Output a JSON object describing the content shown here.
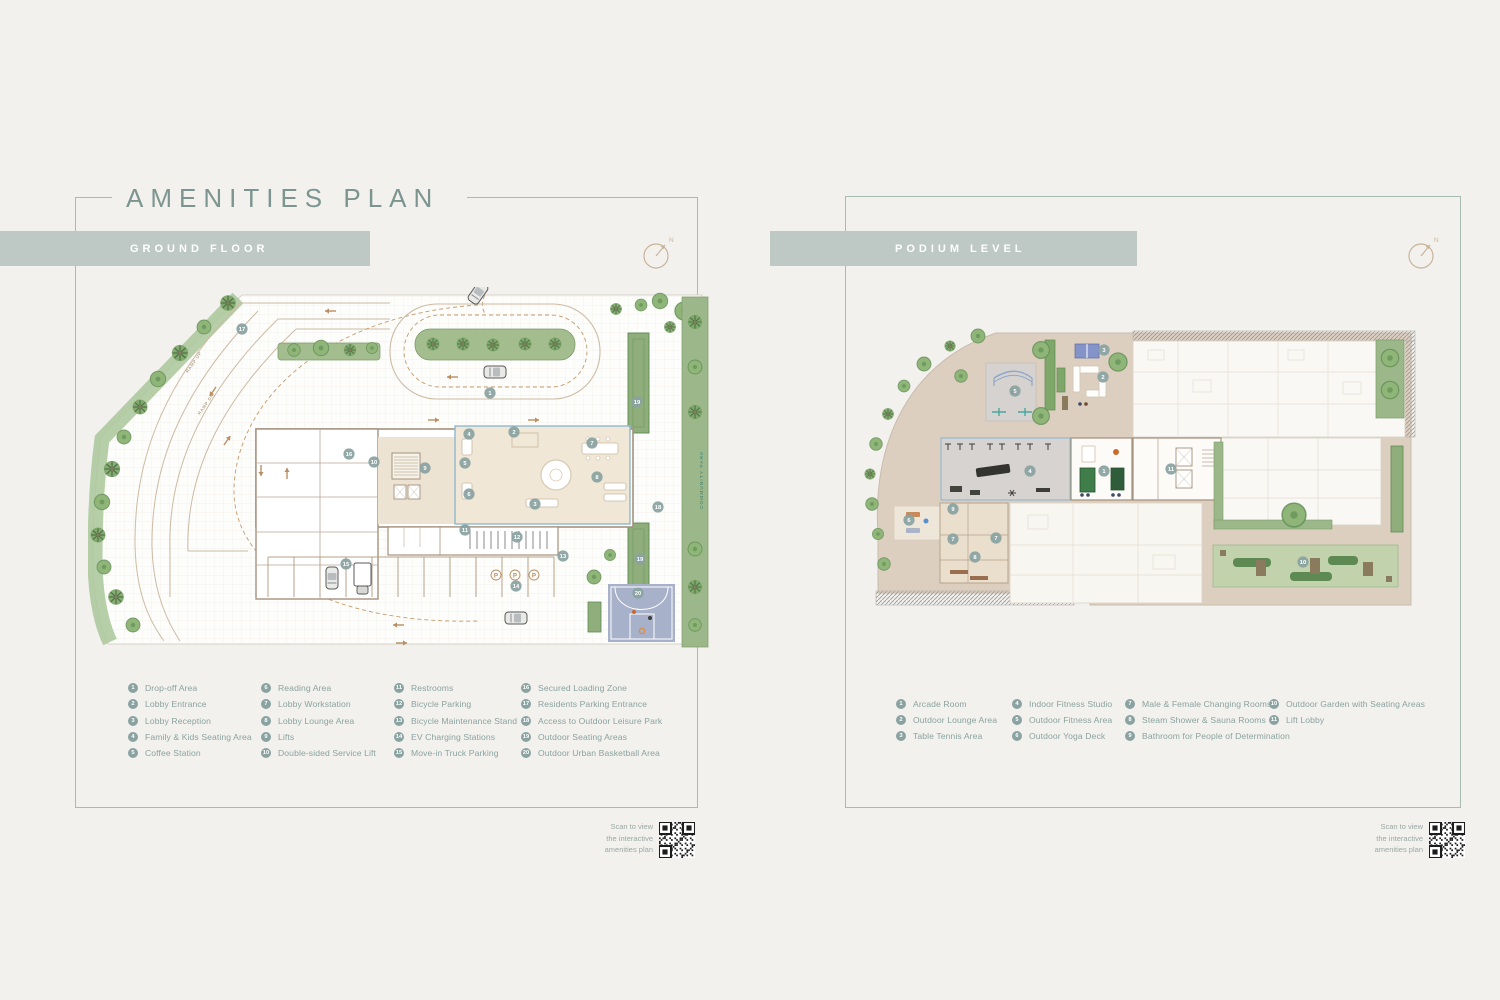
{
  "colors": {
    "background": "#f2f1ee",
    "banner": "#bec8c5",
    "title_teal": "#7d9591",
    "legend_teal": "#8ba39f",
    "marker_fill": "#8aa3a1",
    "panel_border": "#a9bab5",
    "lobby_outline": "#8fb9cf",
    "court_blue": "#a7b1c9",
    "green_strip": "#9cb88a",
    "terrace_tan": "#ddcfc0"
  },
  "left_panel": {
    "title": "AMENITIES PLAN",
    "banner": "GROUND FLOOR",
    "compass": "N",
    "legend": [
      {
        "n": "1",
        "label": "Drop-off Area"
      },
      {
        "n": "2",
        "label": "Lobby Entrance"
      },
      {
        "n": "3",
        "label": "Lobby Reception"
      },
      {
        "n": "4",
        "label": "Family & Kids Seating Area"
      },
      {
        "n": "5",
        "label": "Coffee Station"
      },
      {
        "n": "6",
        "label": "Reading Area"
      },
      {
        "n": "7",
        "label": "Lobby Workstation"
      },
      {
        "n": "8",
        "label": "Lobby Lounge Area"
      },
      {
        "n": "9",
        "label": "Lifts"
      },
      {
        "n": "10",
        "label": "Double-sided Service Lift"
      },
      {
        "n": "11",
        "label": "Restrooms"
      },
      {
        "n": "12",
        "label": "Bicycle Parking"
      },
      {
        "n": "13",
        "label": "Bicycle Maintenance Stand"
      },
      {
        "n": "14",
        "label": "EV Charging Stations"
      },
      {
        "n": "15",
        "label": "Move-in Truck Parking"
      },
      {
        "n": "16",
        "label": "Secured Loading Zone"
      },
      {
        "n": "17",
        "label": "Residents Parking Entrance"
      },
      {
        "n": "18",
        "label": "Access to Outdoor Leisure Park"
      },
      {
        "n": "19",
        "label": "Outdoor Seating Areas"
      },
      {
        "n": "20",
        "label": "Outdoor Urban Basketball Area"
      }
    ],
    "plan": {
      "ramp_up": "RAMP UP",
      "ramp_dn": "RAMP DN",
      "community_park": "COMMUNITY PARK",
      "p_label": "P",
      "markers": [
        {
          "n": "1",
          "x": 402,
          "y": 106
        },
        {
          "n": "2",
          "x": 426,
          "y": 145
        },
        {
          "n": "3",
          "x": 447,
          "y": 217
        },
        {
          "n": "4",
          "x": 381,
          "y": 147
        },
        {
          "n": "5",
          "x": 377,
          "y": 176
        },
        {
          "n": "6",
          "x": 381,
          "y": 207
        },
        {
          "n": "7",
          "x": 504,
          "y": 156
        },
        {
          "n": "8",
          "x": 509,
          "y": 190
        },
        {
          "n": "9",
          "x": 337,
          "y": 181
        },
        {
          "n": "10",
          "x": 286,
          "y": 175
        },
        {
          "n": "11",
          "x": 377,
          "y": 243
        },
        {
          "n": "12",
          "x": 429,
          "y": 250
        },
        {
          "n": "13",
          "x": 475,
          "y": 269
        },
        {
          "n": "14",
          "x": 428,
          "y": 299
        },
        {
          "n": "15",
          "x": 258,
          "y": 277
        },
        {
          "n": "16",
          "x": 261,
          "y": 167
        },
        {
          "n": "17",
          "x": 154,
          "y": 42
        },
        {
          "n": "18",
          "x": 570,
          "y": 220
        },
        {
          "n": "19",
          "x": 549,
          "y": 115
        },
        {
          "n": "19",
          "x": 552,
          "y": 272
        },
        {
          "n": "20",
          "x": 550,
          "y": 306
        }
      ]
    },
    "qr": {
      "lines": [
        "Scan to view",
        "the interactive",
        "amenities plan"
      ]
    }
  },
  "right_panel": {
    "banner": "PODIUM LEVEL",
    "compass": "N",
    "legend": [
      {
        "n": "1",
        "label": "Arcade Room"
      },
      {
        "n": "2",
        "label": "Outdoor Lounge Area"
      },
      {
        "n": "3",
        "label": "Table Tennis Area"
      },
      {
        "n": "4",
        "label": "Indoor Fitness Studio"
      },
      {
        "n": "5",
        "label": "Outdoor Fitness Area"
      },
      {
        "n": "6",
        "label": "Outdoor Yoga Deck"
      },
      {
        "n": "7",
        "label": "Male & Female Changing Rooms"
      },
      {
        "n": "8",
        "label": "Steam Shower & Sauna Rooms"
      },
      {
        "n": "9",
        "label": "Bathroom for People of Determination"
      },
      {
        "n": "10",
        "label": "Outdoor Garden with Seating Areas"
      },
      {
        "n": "11",
        "label": "Lift Lobby"
      }
    ],
    "plan": {
      "markers": [
        {
          "n": "1",
          "x": 246,
          "y": 151
        },
        {
          "n": "2",
          "x": 245,
          "y": 57
        },
        {
          "n": "3",
          "x": 246,
          "y": 30
        },
        {
          "n": "4",
          "x": 172,
          "y": 151
        },
        {
          "n": "5",
          "x": 157,
          "y": 71
        },
        {
          "n": "6",
          "x": 51,
          "y": 200
        },
        {
          "n": "7",
          "x": 95,
          "y": 219
        },
        {
          "n": "7",
          "x": 138,
          "y": 218
        },
        {
          "n": "8",
          "x": 117,
          "y": 237
        },
        {
          "n": "9",
          "x": 95,
          "y": 189
        },
        {
          "n": "10",
          "x": 445,
          "y": 242
        },
        {
          "n": "11",
          "x": 313,
          "y": 149
        }
      ]
    },
    "qr": {
      "lines": [
        "Scan to view",
        "the interactive",
        "amenities plan"
      ]
    }
  }
}
